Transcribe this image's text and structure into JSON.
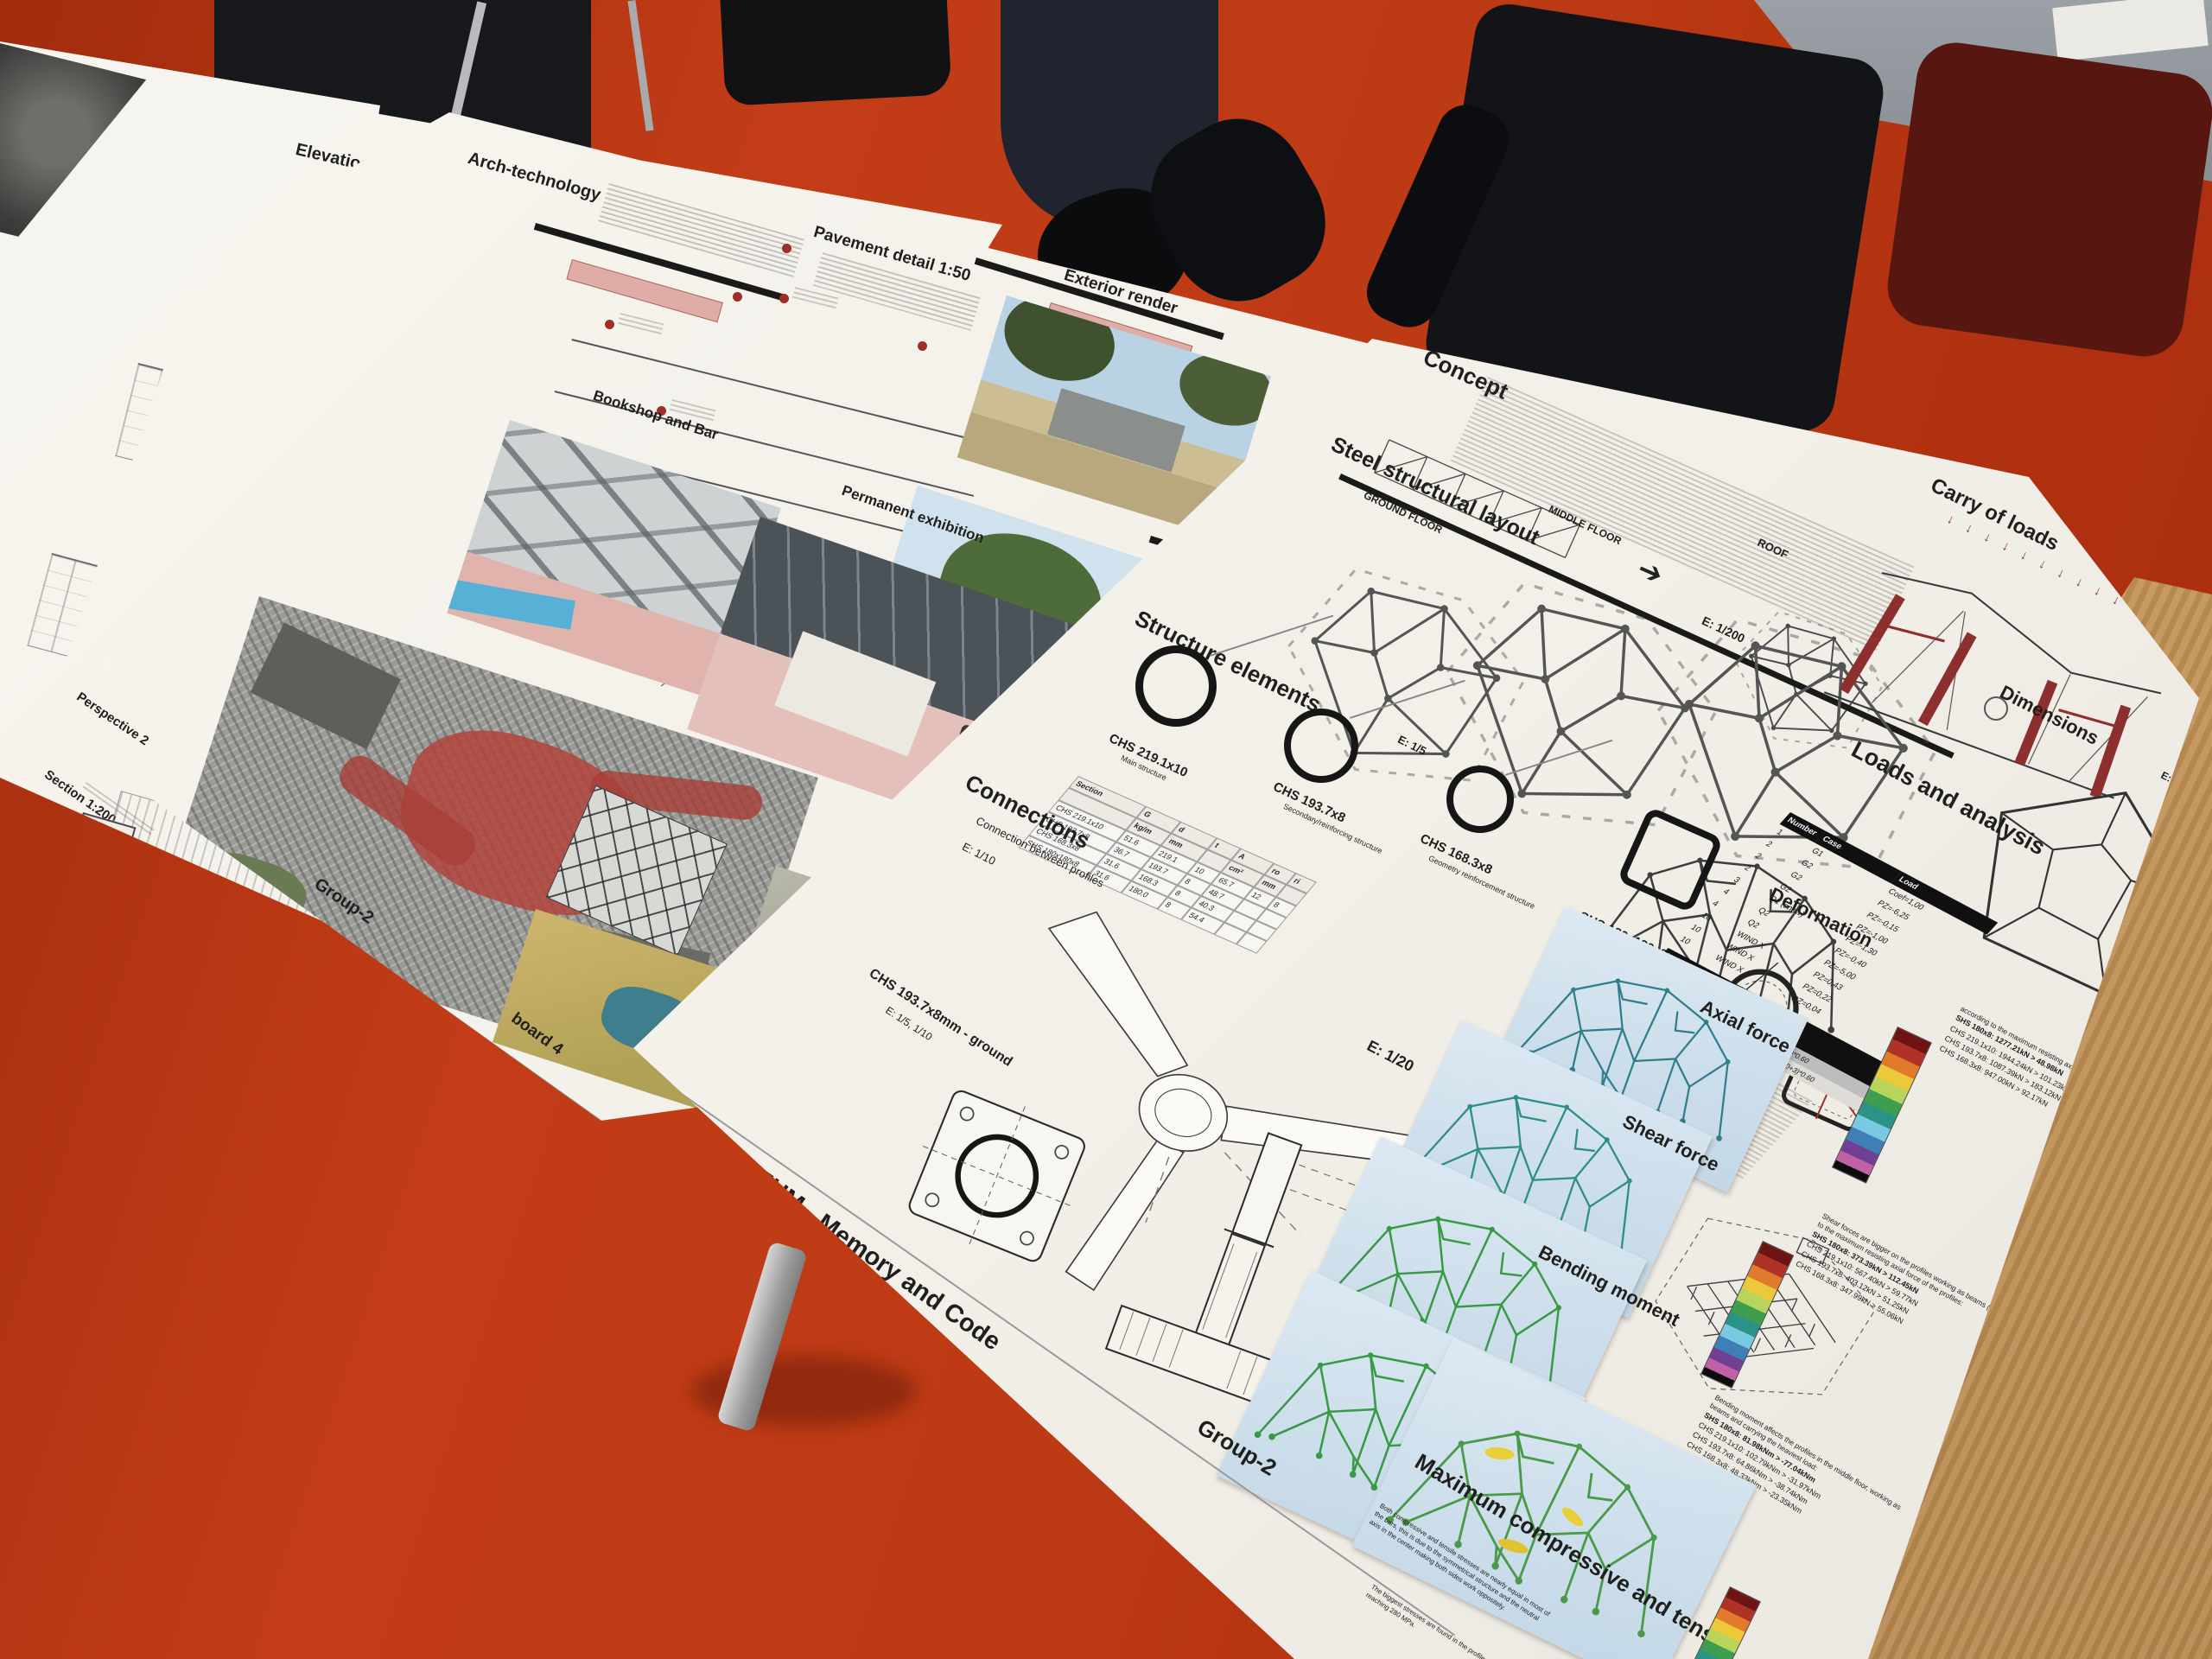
{
  "scene": {
    "floor_color": "#b63712",
    "wood_color": "#c79a5f",
    "paper_color": "#f5f3ec",
    "accent_red": "#9e2f28",
    "fem_panel_blue": "#cfe0ec",
    "carry_arrows": "↓ ↓ ↓ ↓ ↓ ↓ ↓ ↓ ↓ ↓"
  },
  "exploded": {
    "title": "Exploded axonometry"
  },
  "elevations": {
    "title": "Elevations",
    "section_label": "Section 1:200"
  },
  "board4": {
    "arch_title": "Arch-technology",
    "structure_diagram_label": "Structure diagram",
    "etfe_label": "ETFE facade",
    "etfe_detail_label": "ETFE facade section detail 1:10",
    "pavement_title": "Pavement detail 1:50",
    "exterior_title": "Exterior render",
    "bookshop_title": "Bookshop and Bar",
    "exhibition_title": "Permanent exhibition",
    "perspective_label": "Perspective 2",
    "museum_title": "MUPIN MUSEUM - Memory and Code",
    "group_label": "Group-2",
    "board_label": "board 4"
  },
  "right": {
    "concept_title": "Concept",
    "layout_title": "Steel structural layout",
    "layout_scale": "E: 1/200",
    "floors": [
      "GROUND FLOOR",
      "MIDDLE FLOOR",
      "ROOF"
    ],
    "carry_title": "Carry of loads",
    "carry_scale": "E: 1/100",
    "dimensions_title": "Dimensions",
    "dimensions_scale": "E: 1/200",
    "elements_title": "Structure elements",
    "elements_scale": "E: 1/5",
    "profiles": [
      {
        "name": "CHS 219.1x10",
        "desc": "Main structure"
      },
      {
        "name": "CHS 193.7x8",
        "desc": "Secondary/reinforcing structure"
      },
      {
        "name": "CHS 168.3x8",
        "desc": "Geometry reinforcement structure"
      },
      {
        "name": "SHS 180x180x8",
        "desc": "Floor supporting beams"
      }
    ],
    "section_table": {
      "col_section": "Section",
      "col_g": "G",
      "col_g_unit": "kg/m",
      "col_d": "d",
      "col_d_unit": "mm",
      "col_t": "t",
      "col_a": "A",
      "col_a_unit": "cm²",
      "col_ro": "ro",
      "col_ri": "ri",
      "rows": [
        {
          "section": "CHS 219.1x10",
          "g": "51.6",
          "d": "219.1",
          "t": "10",
          "a": "65.7",
          "ro": "12",
          "ri": "8"
        },
        {
          "section": "CHS 193.7x8",
          "g": "36.7",
          "d": "193.7",
          "t": "8",
          "a": "48.7",
          "ro": "",
          "ri": ""
        },
        {
          "section": "CHS 168.3x8",
          "g": "31.6",
          "d": "168.3",
          "t": "8",
          "a": "40.3",
          "ro": "",
          "ri": ""
        },
        {
          "section": "SHS 180x180x8",
          "g": "31.6",
          "d": "180.0",
          "t": "8",
          "a": "54.4",
          "ro": "",
          "ri": ""
        }
      ]
    },
    "connections_title": "Connections",
    "connections_sub": "Connection between profiles",
    "connections_scale": "E: 1/10",
    "ground_label": "CHS 193.7x8mm - ground",
    "ground_scale": "E: 1/5, 1/10",
    "mid_scale": "E: 1/20",
    "loads_title": "Loads and analysis",
    "loads_table": {
      "col_number": "Number",
      "col_case": "Case",
      "col_load": "Load",
      "rows": [
        {
          "n": "1",
          "case": "G1",
          "load": "Coef=1,00"
        },
        {
          "n": "2",
          "case": "G2",
          "load": "PZ=-6,25"
        },
        {
          "n": "2",
          "case": "G2",
          "load": "PZ=-0,15"
        },
        {
          "n": "2",
          "case": "G2",
          "load": "PZ=-1,00"
        },
        {
          "n": "3",
          "case": "Q1 (snow)",
          "load": "PZ=-1,30"
        },
        {
          "n": "4",
          "case": "Q2",
          "load": "PZ=-0,40"
        },
        {
          "n": "4",
          "case": "Q2",
          "load": "PZ=-5,00"
        },
        {
          "n": "10",
          "case": "WIND X",
          "load": "PZ=0,43"
        },
        {
          "n": "10",
          "case": "WIND X",
          "load": "PZ=0,22"
        },
        {
          "n": "10",
          "case": "WIND X",
          "load": "PZ=0,04"
        }
      ]
    },
    "comb_table": {
      "col_name": "Name",
      "col_type": "Type of combination",
      "col_def": "Definition",
      "rows": [
        {
          "name": "SLS X",
          "type": "ELS",
          "def": "(1+2+4)*1.00+(4+10)*0.60"
        },
        {
          "name": "ULS X",
          "type": "ELU",
          "def": "1*1.30+(2+4)*1.50+(10+3)*0.60"
        }
      ]
    },
    "fem": {
      "deformation_title": "Deformation",
      "axial_title": "Axial force",
      "shear_title": "Shear force",
      "bending_title": "Bending moment",
      "max_title": "Maximum compressive and tensile",
      "axial_note": "according to the maximum resisting axial force of the profiles:",
      "axial_items": [
        "SHS 180x8: 1277.21kN > 48.98kN",
        "CHS 219.1x10: 1944.24kN > 101.23kN",
        "CHS 193.7x8: 1087.39kN > 183.12kN",
        "CHS 168.3x8: 947.00kN > 92.17kN"
      ],
      "shear_note": "Shear forces are bigger on the profiles working as beams (SHS), according to the maximum resisting axial force of the profiles:",
      "shear_items": [
        "SHS 180x8: 373.39kN > 112.45kN",
        "CHS 219.1x10: 567.40kN > 59.77kN",
        "CHS 193.7x8: 403.12kN > 51.25kN",
        "CHS 168.3x8: 347.99kN > 55.06kN"
      ],
      "bending_note": "Bending moment affects the profiles in the middle floor, working as beams and carrying the heaviest load:",
      "bending_items": [
        "SHS 180x8: 81.98kNm > -77.04kNm",
        "CHS 219.1x10: 102.79kNm > -31.97kNm",
        "CHS 193.7x8: 64.86kNm > -38.74kNm",
        "CHS 168.3x8: 48.33kNm > -23.35kNm"
      ],
      "max_note": "Both compressive and tensile stresses are nearly equal in most of the bars, this is due to the symmetrical structure and the neutral axis in the center making both sides work oppositely.",
      "max_note2": "The biggest stresses are found in the profiles working as beams, reaching 280 MPa."
    },
    "museum_title": "MUPIN MUSEUM - Memory and Code",
    "group_label": "Group-2"
  }
}
